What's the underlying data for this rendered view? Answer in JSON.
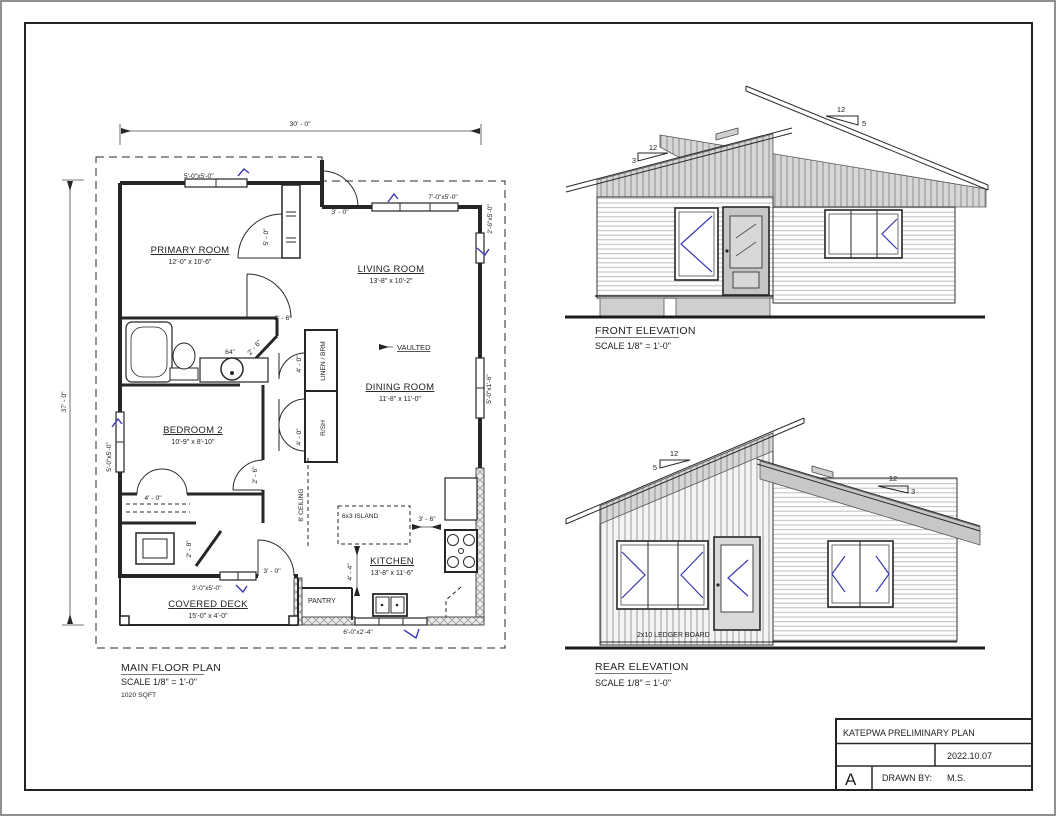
{
  "colors": {
    "accent_blue": "#3a3ab5",
    "ink": "#262626",
    "shade_gray": "#c9c9c9"
  },
  "title_block": {
    "project": "KATEPWA PRELIMINARY PLAN",
    "date": "2022.10.07",
    "drawn_by_label": "DRAWN BY:",
    "drawn_by": "M.S.",
    "sheet": "A"
  },
  "floor_plan": {
    "title": "MAIN FLOOR PLAN",
    "scale": "SCALE 1/8\" = 1'-0\"",
    "area": "1020 SQFT",
    "overall_width": "30' - 0\"",
    "overall_depth": "37' - 0\"",
    "rooms": [
      {
        "name": "PRIMARY ROOM",
        "size": "12'-0\" x 10'-6\""
      },
      {
        "name": "LIVING ROOM",
        "size": "13'-8\" x 10'-2\""
      },
      {
        "name": "DINING ROOM",
        "size": "11'-8\" x 11'-0\""
      },
      {
        "name": "BEDROOM 2",
        "size": "10'-9\" x 8'-10\""
      },
      {
        "name": "KITCHEN",
        "size": "13'-8\" x 11'-6\""
      },
      {
        "name": "COVERED DECK",
        "size": "15'-0\" x 4'-0\""
      }
    ],
    "annotations": {
      "vaulted": "VAULTED",
      "ceiling": "8' CEILING",
      "island": "6x3 ISLAND",
      "pantry": "PANTRY",
      "linen_closet": "LINEN / BRM",
      "shelf_closet": "R/SH",
      "vanity_width": "64\""
    },
    "windows": {
      "primary_top": "5'-0\"x5'-0\"",
      "living_top": "7'-0\"x5'-0\"",
      "living_right": "2'-6\"x5'-0\"",
      "dining_right": "5'-0\"x1'-6\"",
      "bedroom_left": "5'-0\"x5'-0\"",
      "bedroom_bottom": "3'-0\"x5'-0\"",
      "kitchen_patio": "6'-0\"x2'-4\""
    },
    "dimensions": {
      "entry_door": "3' - 0\"",
      "primary_closet": "5' - 0\"",
      "hall_width": "2' - 6\"",
      "bath_door": "2' - 6\"",
      "linen_width": "4' - 0\"",
      "shelf_width": "4' - 0\"",
      "bedroom_door": "2' - 6\"",
      "bedroom_closet": "4' - 0\"",
      "mech_door": "2' - 8\"",
      "deck_door": "3' - 0\"",
      "island_clearance": "3' - 6\"",
      "kitchen_aisle": "4' - 4\""
    }
  },
  "front_elevation": {
    "title": "FRONT ELEVATION",
    "scale": "SCALE 1/8\" = 1'-0\"",
    "main_pitch_run": "12",
    "main_pitch_rise": "5",
    "porch_pitch_run": "12",
    "porch_pitch_rise": "3"
  },
  "rear_elevation": {
    "title": "REAR ELEVATION",
    "scale": "SCALE 1/8\" = 1'-0\"",
    "left_pitch_run": "12",
    "left_pitch_rise": "5",
    "right_pitch_run": "12",
    "right_pitch_rise": "3",
    "ledger": "2x10 LEDGER BOARD"
  }
}
